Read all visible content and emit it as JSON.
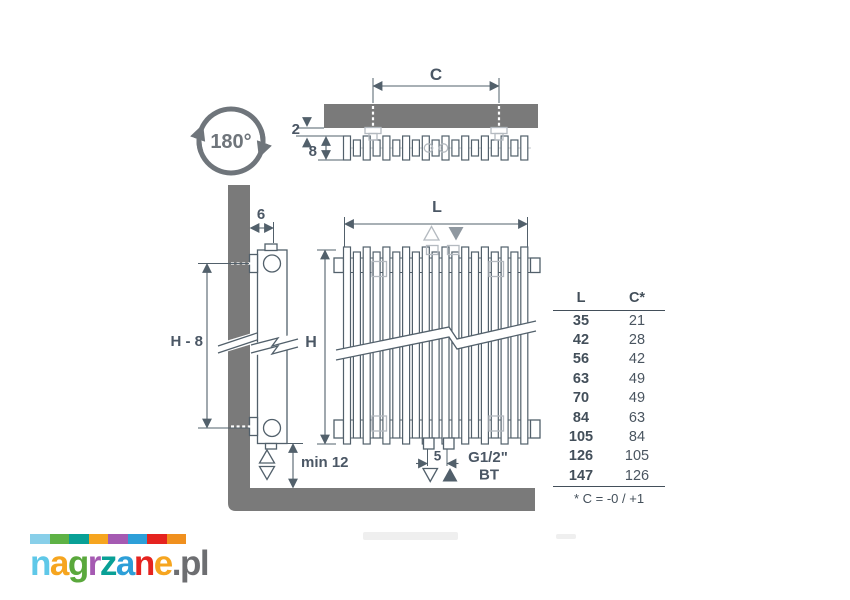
{
  "colors": {
    "ink": "#52606b",
    "wall_gray": "#7a7a7a",
    "light_gray": "#b4bac0",
    "rotation_gray": "#6f757b"
  },
  "labels": {
    "rotation": "180°",
    "dim_c": "C",
    "dim_2": "2",
    "dim_8": "8",
    "dim_6": "6",
    "dim_h_minus_8": "H - 8",
    "dim_min_12": "min 12",
    "dim_l": "L",
    "dim_h": "H",
    "dim_5": "5",
    "connection_size": "G1/2\"",
    "connection_code": "BT"
  },
  "table": {
    "col_l": "L",
    "col_c": "C*",
    "rows": [
      [
        "35",
        "21"
      ],
      [
        "42",
        "28"
      ],
      [
        "56",
        "42"
      ],
      [
        "63",
        "49"
      ],
      [
        "70",
        "49"
      ],
      [
        "84",
        "63"
      ],
      [
        "105",
        "84"
      ],
      [
        "126",
        "105"
      ],
      [
        "147",
        "126"
      ]
    ],
    "footnote": "* C = -0 / +1"
  },
  "logo": {
    "bar_colors": [
      "#88cfe9",
      "#5eb245",
      "#09a096",
      "#f6a51f",
      "#a55ab2",
      "#2d9fd8",
      "#e5231f",
      "#f0901e"
    ],
    "letters": [
      {
        "ch": "n",
        "color": "#5fc8e8"
      },
      {
        "ch": "a",
        "color": "#f6a51f"
      },
      {
        "ch": "g",
        "color": "#5aa83c"
      },
      {
        "ch": "r",
        "color": "#a55ab2"
      },
      {
        "ch": "z",
        "color": "#09a096"
      },
      {
        "ch": "a",
        "color": "#2d9fd8"
      },
      {
        "ch": "n",
        "color": "#e5231f"
      },
      {
        "ch": "e",
        "color": "#f6a51f"
      },
      {
        "ch": ".",
        "color": "#6d6e71"
      },
      {
        "ch": "p",
        "color": "#6d6e71"
      },
      {
        "ch": "l",
        "color": "#6d6e71"
      }
    ]
  }
}
